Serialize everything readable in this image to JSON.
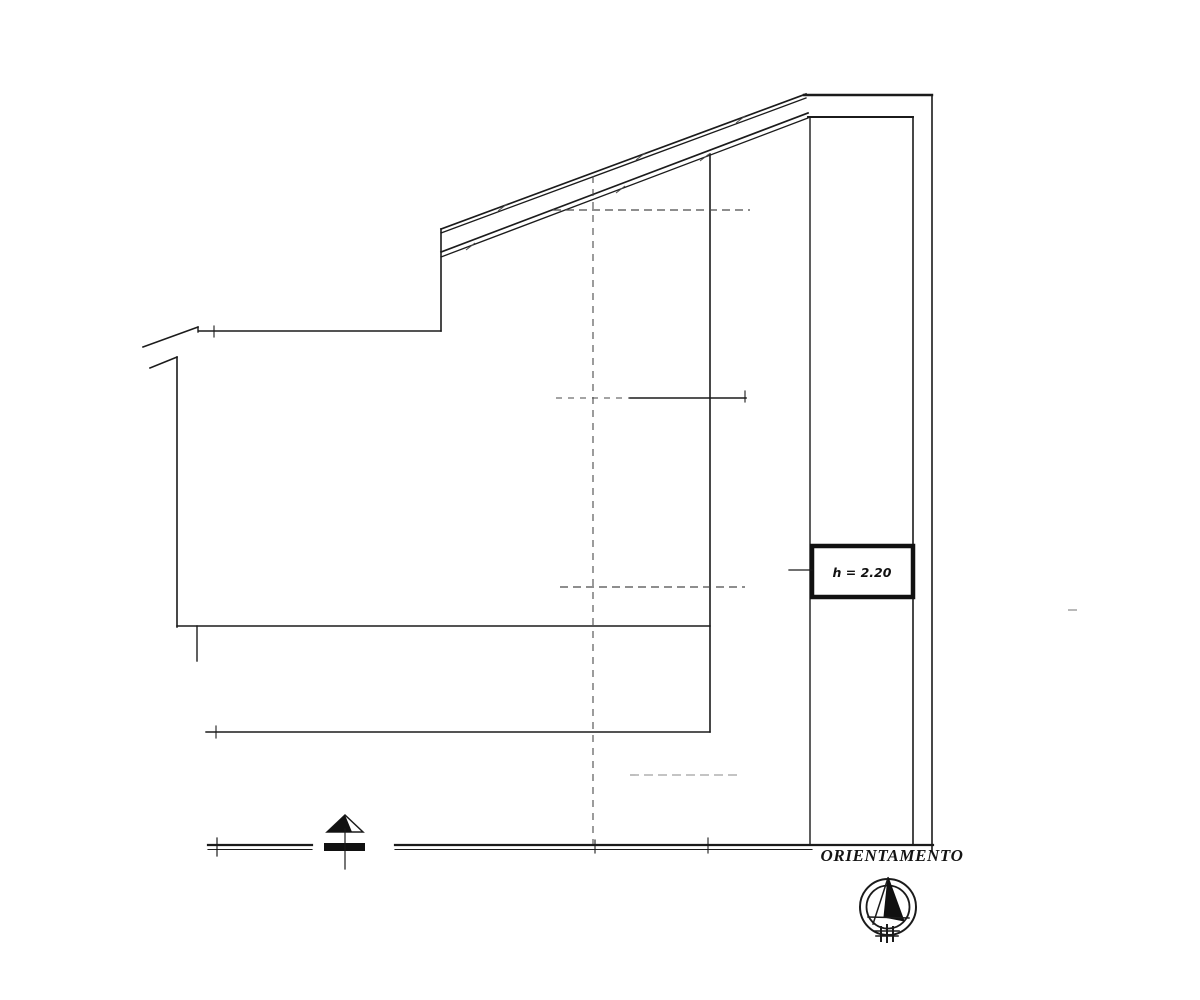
{
  "page": {
    "background_color": "#ffffff",
    "ink_color": "#1b1b1b"
  },
  "drawing": {
    "kind": "architectural-section-plan-scan",
    "labels": {
      "height_label": "h = 2.20",
      "orientation_label": "ORIENTAMENTO"
    },
    "icons": [
      {
        "name": "compass-icon"
      },
      {
        "name": "chimney-arrow-icon"
      }
    ]
  }
}
